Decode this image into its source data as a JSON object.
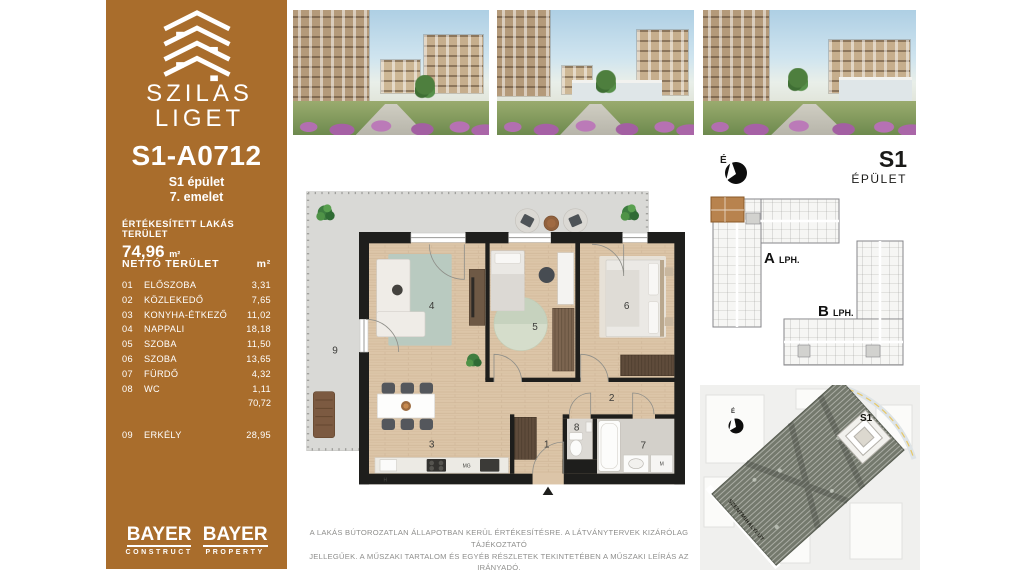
{
  "meta": {
    "accent_brown": "#a96d2c",
    "wall_black": "#1e1e1c",
    "wood_floor": "#dcc5a8",
    "balcony_gray": "#d9d9d6"
  },
  "sidebar": {
    "brand_line1": "SZILAS",
    "brand_line2": "LIGET",
    "unit_id": "S1-A0712",
    "building": "S1 épület",
    "floor": "7. emelet",
    "sold_area_label": "ÉRTÉKESÍTETT LAKÁS TERÜLET",
    "sold_area_value": "74,96",
    "sold_area_unit": "m²",
    "net_table": {
      "header_label": "NETTÓ TERÜLET",
      "header_unit": "m²",
      "rows": [
        {
          "num": "01",
          "name": "ELŐSZOBA",
          "area": "3,31"
        },
        {
          "num": "02",
          "name": "KÖZLEKEDŐ",
          "area": "7,65"
        },
        {
          "num": "03",
          "name": "KONYHA-ÉTKEZŐ",
          "area": "11,02"
        },
        {
          "num": "04",
          "name": "NAPPALI",
          "area": "18,18"
        },
        {
          "num": "05",
          "name": "SZOBA",
          "area": "11,50"
        },
        {
          "num": "06",
          "name": "SZOBA",
          "area": "13,65"
        },
        {
          "num": "07",
          "name": "FÜRDŐ",
          "area": "4,32"
        },
        {
          "num": "08",
          "name": "WC",
          "area": "1,11"
        }
      ],
      "subtotal": "70,72",
      "balcony_row": {
        "num": "09",
        "name": "ERKÉLY",
        "area": "28,95"
      }
    },
    "logos": [
      {
        "name": "BAYER",
        "division": "CONSTRUCT"
      },
      {
        "name": "BAYER",
        "division": "PROPERTY"
      }
    ]
  },
  "floor_plan": {
    "room_numbers": [
      "1",
      "2",
      "3",
      "4",
      "5",
      "6",
      "7",
      "8",
      "9"
    ],
    "appliance_labels": {
      "fridge": "H",
      "dishwasher": "MG",
      "washer": "M"
    }
  },
  "key_plan": {
    "north_label": "É",
    "building_code": "S1",
    "building_word": "ÉPÜLET",
    "stairwell_a": "A",
    "stairwell_a_suffix": "LPH.",
    "stairwell_b": "B",
    "stairwell_b_suffix": "LPH."
  },
  "site_map": {
    "north_label": "É",
    "building_label": "S1",
    "street_name": "SZENTMIHÁLYI ÚT"
  },
  "disclaimer_line1": "A LAKÁS BÚTOROZATLAN ÁLLAPOTBAN KERÜL ÉRTÉKESÍTÉSRE. A LÁTVÁNYTERVEK KIZÁRÓLAG TÁJÉKOZTATÓ",
  "disclaimer_line2": "JELLEGŰEK. A MŰSZAKI TARTALOM ÉS EGYÉB RÉSZLETEK TEKINTETÉBEN A MŰSZAKI LEÍRÁS AZ IRÁNYADÓ."
}
